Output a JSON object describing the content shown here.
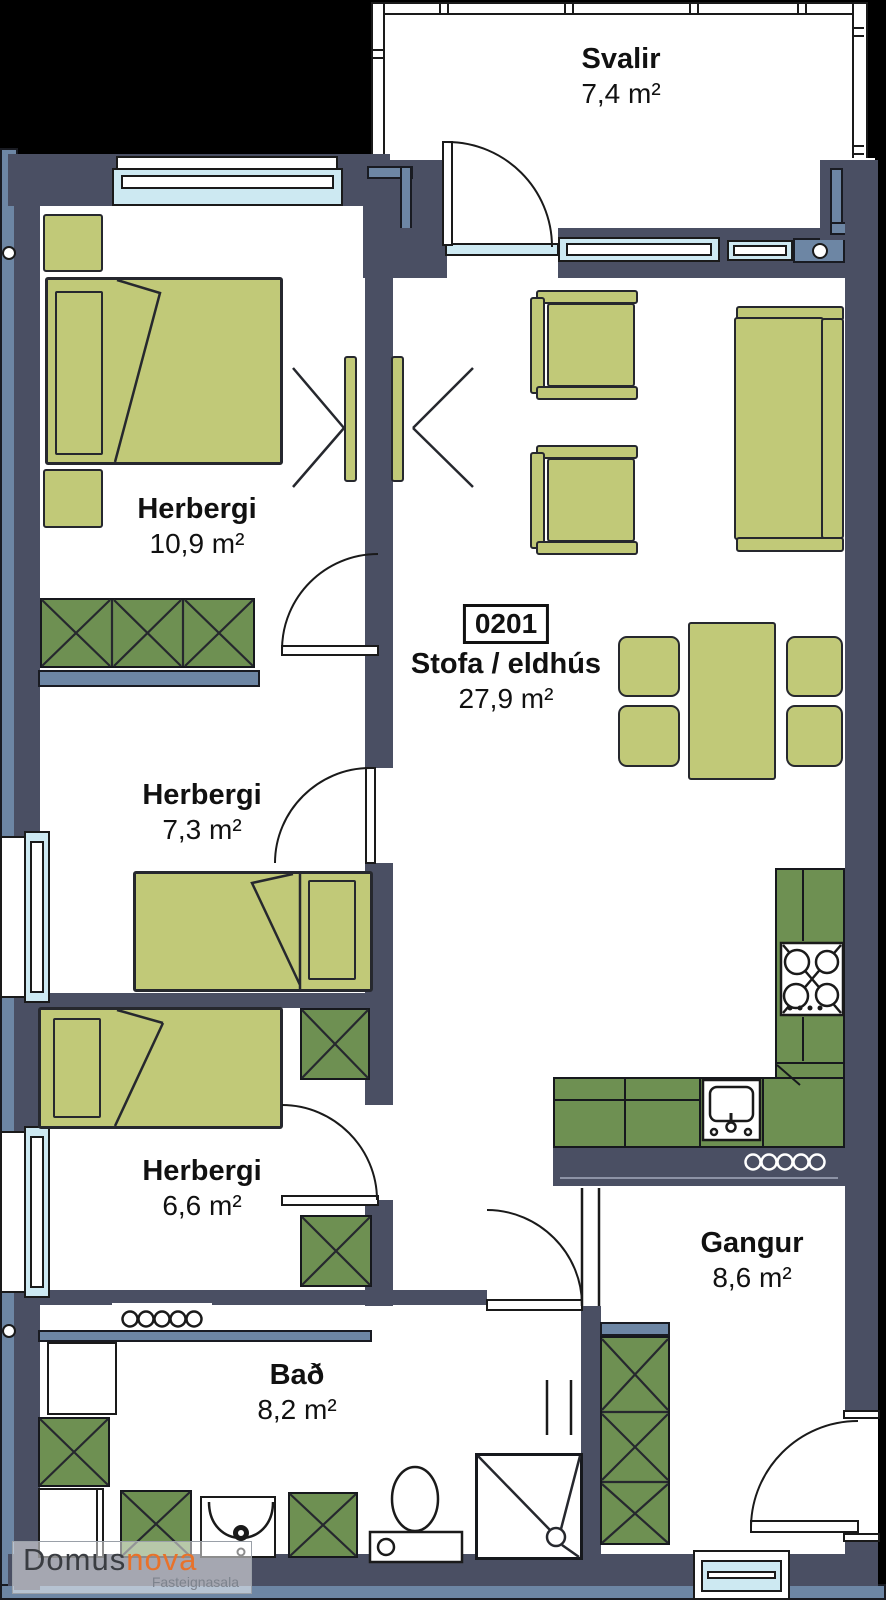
{
  "plan": {
    "unit_number": "0201",
    "rooms": [
      {
        "name": "Svalir",
        "area": "7,4 m²"
      },
      {
        "name": "Herbergi",
        "area": "10,9 m²"
      },
      {
        "name": "Stofa / eldhús",
        "area": "27,9 m²"
      },
      {
        "name": "Herbergi",
        "area": "7,3 m²"
      },
      {
        "name": "Herbergi",
        "area": "6,6 m²"
      },
      {
        "name": "Gangur",
        "area": "8,6 m²"
      },
      {
        "name": "Bað",
        "area": "8,2 m²"
      }
    ],
    "logo": {
      "name": "Domus",
      "accent": "nova",
      "tagline": "Fasteignasala"
    },
    "colors": {
      "wall": "#4a4f63",
      "wall_light": "#6d86a4",
      "furniture": "#c1c978",
      "cabinet": "#6e9052",
      "window": "#cde9f2",
      "background": "#000000"
    }
  }
}
